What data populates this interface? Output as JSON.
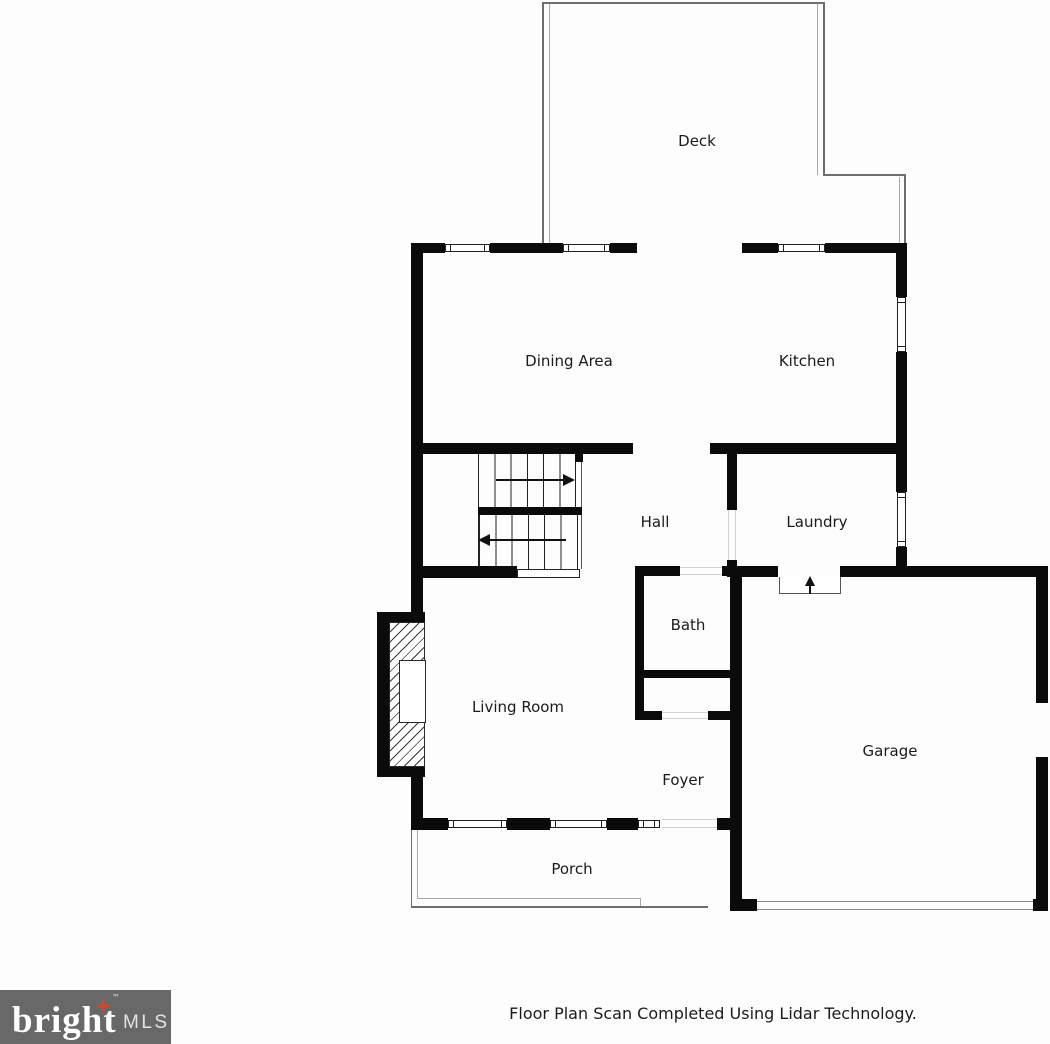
{
  "rooms": {
    "deck": "Deck",
    "dining": "Dining Area",
    "kitchen": "Kitchen",
    "hall": "Hall",
    "laundry": "Laundry",
    "bath": "Bath",
    "living": "Living Room",
    "foyer": "Foyer",
    "garage": "Garage",
    "porch": "Porch"
  },
  "footer": {
    "caption": "Floor Plan Scan Completed Using Lidar Technology."
  },
  "logo": {
    "brand": "bright",
    "trademark": "™",
    "suffix": "MLS"
  },
  "colors": {
    "wall": "#0b0b0b",
    "thin_outline": "#6e6e6e",
    "door_line": "#d2d2d2",
    "logo_background": "#686868",
    "logo_star": "#cc4a2e",
    "text": "#1b1b1b"
  }
}
